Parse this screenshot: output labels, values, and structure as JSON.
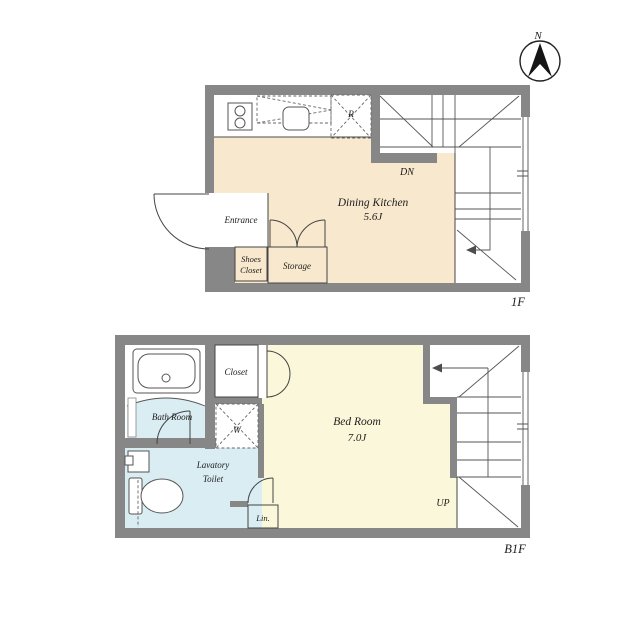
{
  "compass": {
    "north": "N"
  },
  "colors": {
    "wall": "#878787",
    "dk_floor": "#f8e8cd",
    "bedroom_floor": "#fbf7da",
    "wet_floor": "#d9edf2",
    "closet": "#ddc394",
    "storage": "#d8b981",
    "line": "#4d4d4d",
    "text": "#1c1c1c"
  },
  "floor_1f": {
    "floor_label": "1F",
    "dining_kitchen": {
      "name": "Dining Kitchen",
      "size": "5.6J"
    },
    "entrance": "Entrance",
    "shoes_closet": {
      "line1": "Shoes",
      "line2": "Closet"
    },
    "storage": "Storage",
    "refrigerator": "R",
    "stairs_down": "DN"
  },
  "floor_b1f": {
    "floor_label": "B1F",
    "bed_room": {
      "name": "Bed Room",
      "size": "7.0J"
    },
    "bath_room": "Bath Room",
    "closet": "Closet",
    "washer": "W",
    "lavatory": {
      "line1": "Lavatory",
      "line2": "Toilet"
    },
    "linen": "Lin.",
    "stairs_up": "UP"
  }
}
